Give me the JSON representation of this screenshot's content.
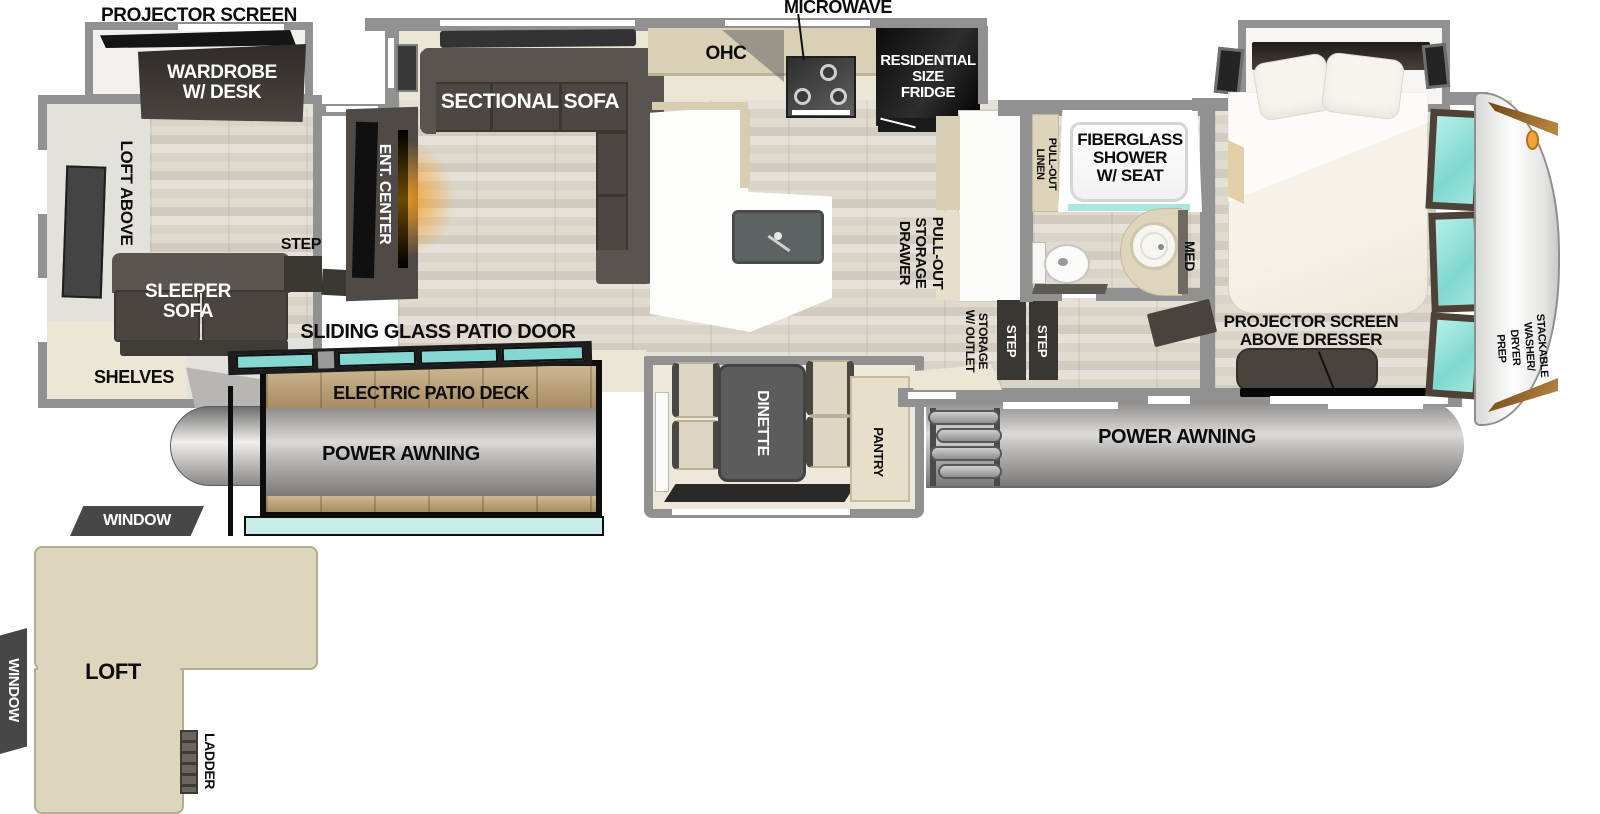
{
  "labels": {
    "projector_screen_top": "PROJECTOR SCREEN",
    "wardrobe_desk": "WARDROBE\nW/ DESK",
    "loft_above": "LOFT ABOVE",
    "sleeper_sofa": "SLEEPER\nSOFA",
    "shelves": "SHELVES",
    "step_front": "STEP",
    "ent_center": "ENT. CENTER",
    "sectional_sofa": "SECTIONAL SOFA",
    "ohc": "OHC",
    "microwave": "MICROWAVE",
    "fridge": "RESIDENTIAL\nSIZE\nFRIDGE",
    "pull_out_storage_drawer": "PULL-OUT\nSTORAGE\nDRAWER",
    "storage_w_outlet": "STORAGE\nW/ OUTLET",
    "step_v1": "STEP",
    "step_v2": "STEP",
    "pull_out_linen": "PULL-OUT\nLINEN",
    "shower": "FIBERGLASS\nSHOWER\nW/ SEAT",
    "med": "MED",
    "projector_above_dresser": "PROJECTOR SCREEN\nABOVE DRESSER",
    "wardrobe": "WARDROBE",
    "stackable_washer_dryer_prep": "STACKABLE\nWASHER/\nDRYER\nPREP",
    "sliding_glass_patio_door": "SLIDING GLASS PATIO DOOR",
    "electric_patio_deck": "ELECTRIC PATIO DECK",
    "power_awning_left": "POWER AWNING",
    "power_awning_right": "POWER AWNING",
    "dinette": "DINETTE",
    "pantry": "PANTRY",
    "window_top": "WINDOW",
    "window_left": "WINDOW",
    "loft": "LOFT",
    "ladder": "LADDER"
  },
  "colors": {
    "wall": "#919191",
    "beige": "#ece6d7",
    "counter_tan": "#d9d0b6",
    "dark_furniture": "#4b4643",
    "teal_glass": "#85d8d2",
    "deck_wood": "#bda06f",
    "loft_fill": "#ddd6bd",
    "label_dark_bg": "#474747",
    "accent_orange": "#f2a337",
    "fireplace_glow": "#f59d1e"
  }
}
